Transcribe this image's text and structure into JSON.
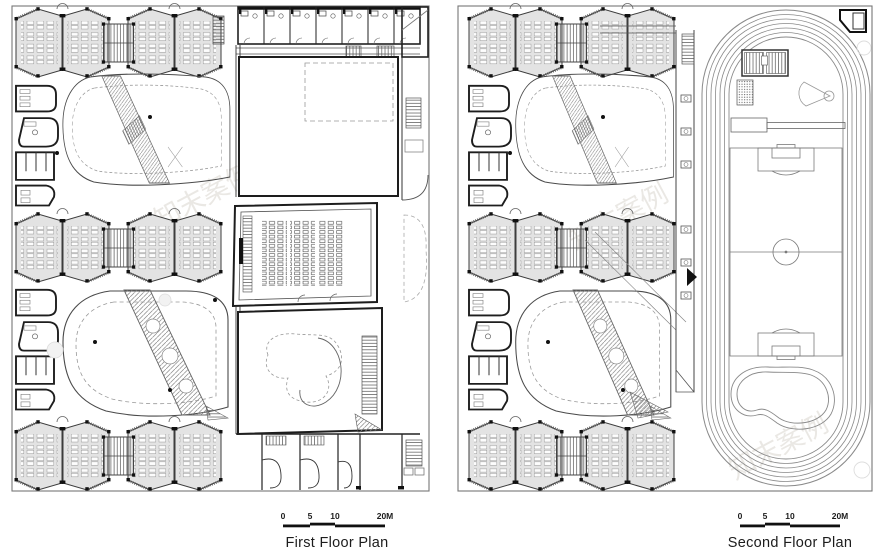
{
  "plans": [
    {
      "id": "first-floor",
      "label": "First Floor Plan",
      "scale": {
        "ticks": [
          "0",
          "5",
          "10",
          "20M"
        ]
      }
    },
    {
      "id": "second-floor",
      "label": "Second Floor Plan",
      "scale": {
        "ticks": [
          "0",
          "5",
          "10",
          "20M"
        ]
      }
    }
  ],
  "watermark": {
    "text": "知末案例"
  },
  "colors": {
    "background": "#ffffff",
    "ink": "#1d1d1d",
    "line": "#4a4a4a",
    "light_line": "#999999",
    "room_fill": "#e3e3e3",
    "watermark": "#cfc9c0"
  }
}
